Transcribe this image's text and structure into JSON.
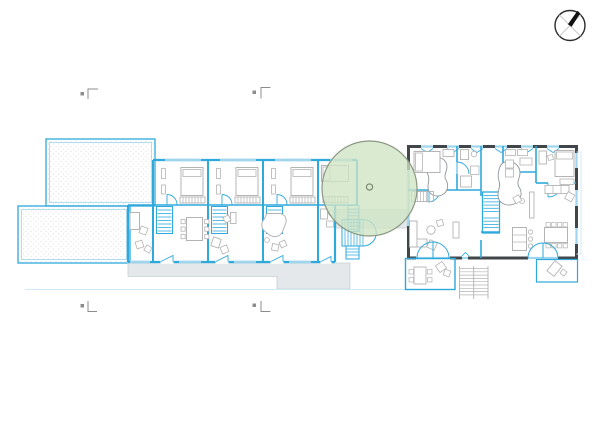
{
  "canvas": {
    "width": 600,
    "height": 425,
    "background": "#ffffff"
  },
  "colors": {
    "cyan": "#2ea9db",
    "cyanLight": "#9fd6ee",
    "cyanPale": "#cfe9f6",
    "dark": "#41464a",
    "gray": "#b4b4b4",
    "marker": "#8c8c8c",
    "walkway": "#e5e8ea",
    "walkwayEdge": "#c9cfd2",
    "treeFill": "#cfe4c4",
    "treeStroke": "#8a9883",
    "trunkStroke": "#75846e",
    "hatchDot": "#d4d9db",
    "north": "#111111",
    "northCross": "#c9c9c9"
  },
  "symbols": {
    "north_arrow": "compass-circle-with-needle",
    "tree": "deciduous-tree-canopy-with-trunk",
    "section_markers": [
      {
        "position": "top-left"
      },
      {
        "position": "top-center"
      },
      {
        "position": "bottom-left"
      },
      {
        "position": "bottom-center"
      }
    ]
  },
  "plan": {
    "left_building": {
      "style": "cyan-linework",
      "units": 4,
      "rooms_per_unit": [
        "bedroom",
        "stair",
        "living-room"
      ],
      "hatched_terraces": 2
    },
    "right_building": {
      "style": "dark-exterior-walls-cyan-partitions",
      "features": [
        "bedrooms",
        "bathrooms",
        "internal-stair",
        "kitchen-island",
        "dining-table",
        "sofas",
        "terrace-left",
        "terrace-right",
        "external-steps",
        "french-doors"
      ]
    }
  }
}
